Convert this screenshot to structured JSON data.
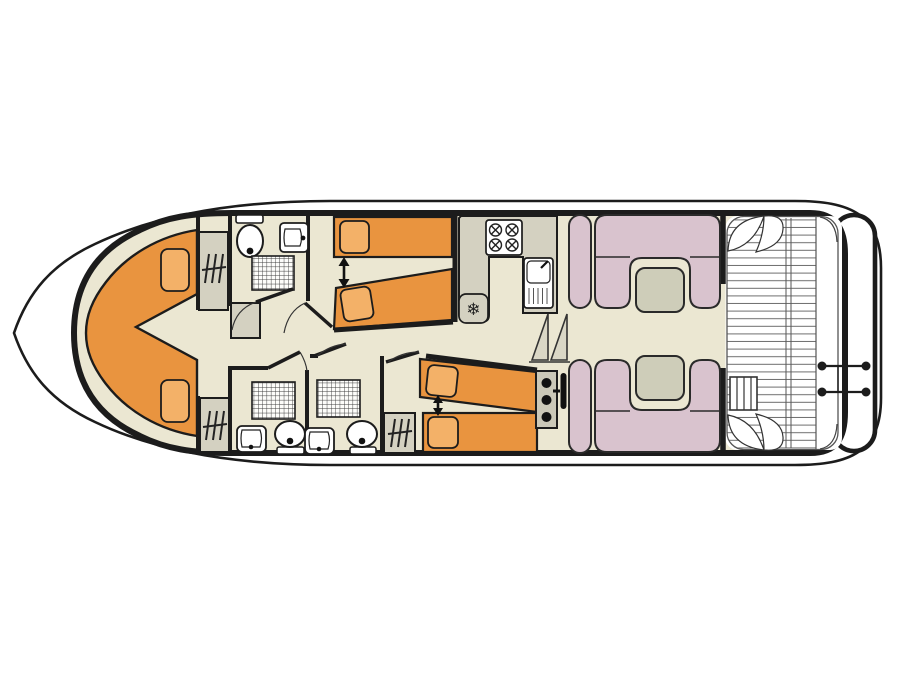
{
  "plan": {
    "type": "boat-deck-floor-plan",
    "orientation": "bow-left-stern-right",
    "fridge_glyph": "❄",
    "rooms": [
      {
        "name": "bow-cabin",
        "features": [
          "v-shaped-double-berth",
          "two-pillows"
        ]
      },
      {
        "name": "forward-wardrobe-top",
        "features": [
          "hanging-locker"
        ]
      },
      {
        "name": "forward-wardrobe-bottom",
        "features": [
          "hanging-locker"
        ]
      },
      {
        "name": "bathroom-top",
        "features": [
          "toilet",
          "washbasin",
          "shower"
        ]
      },
      {
        "name": "bathroom-bottom-left",
        "features": [
          "shower",
          "washbasin",
          "toilet"
        ]
      },
      {
        "name": "bathroom-bottom-middle",
        "features": [
          "shower",
          "washbasin",
          "toilet"
        ]
      },
      {
        "name": "guest-cabin-top",
        "features": [
          "two-single-beds",
          "slide-together-arrow",
          "two-pillows"
        ]
      },
      {
        "name": "guest-cabin-bottom",
        "features": [
          "two-single-beds",
          "slide-together-arrow",
          "two-pillows",
          "wardrobe"
        ]
      },
      {
        "name": "galley",
        "features": [
          "four-burner-hob",
          "sink-with-drainer",
          "fridge"
        ]
      },
      {
        "name": "companionway",
        "features": [
          "steps"
        ]
      },
      {
        "name": "saloon",
        "features": [
          "u-shaped-settee-top",
          "u-shaped-settee-bottom",
          "two-tables"
        ]
      },
      {
        "name": "helm",
        "features": [
          "instrument-console",
          "steering-wheel"
        ]
      },
      {
        "name": "aft-deck",
        "features": [
          "plank-floor",
          "corner-seats",
          "boarding-steps"
        ]
      },
      {
        "name": "swim-platform",
        "features": [
          "stern-ladder"
        ]
      }
    ]
  },
  "palette": {
    "floor": "#ebe7d2",
    "bed": "#e9943f",
    "pillow": "#f3b168",
    "sofa": "#d9c3ce",
    "table": "#cecdb9",
    "unit": "#d4d1c1",
    "console": "#cbc8b8",
    "stair": "#dad7c6",
    "white": "#ffffff",
    "line": "#1c1c1c"
  }
}
